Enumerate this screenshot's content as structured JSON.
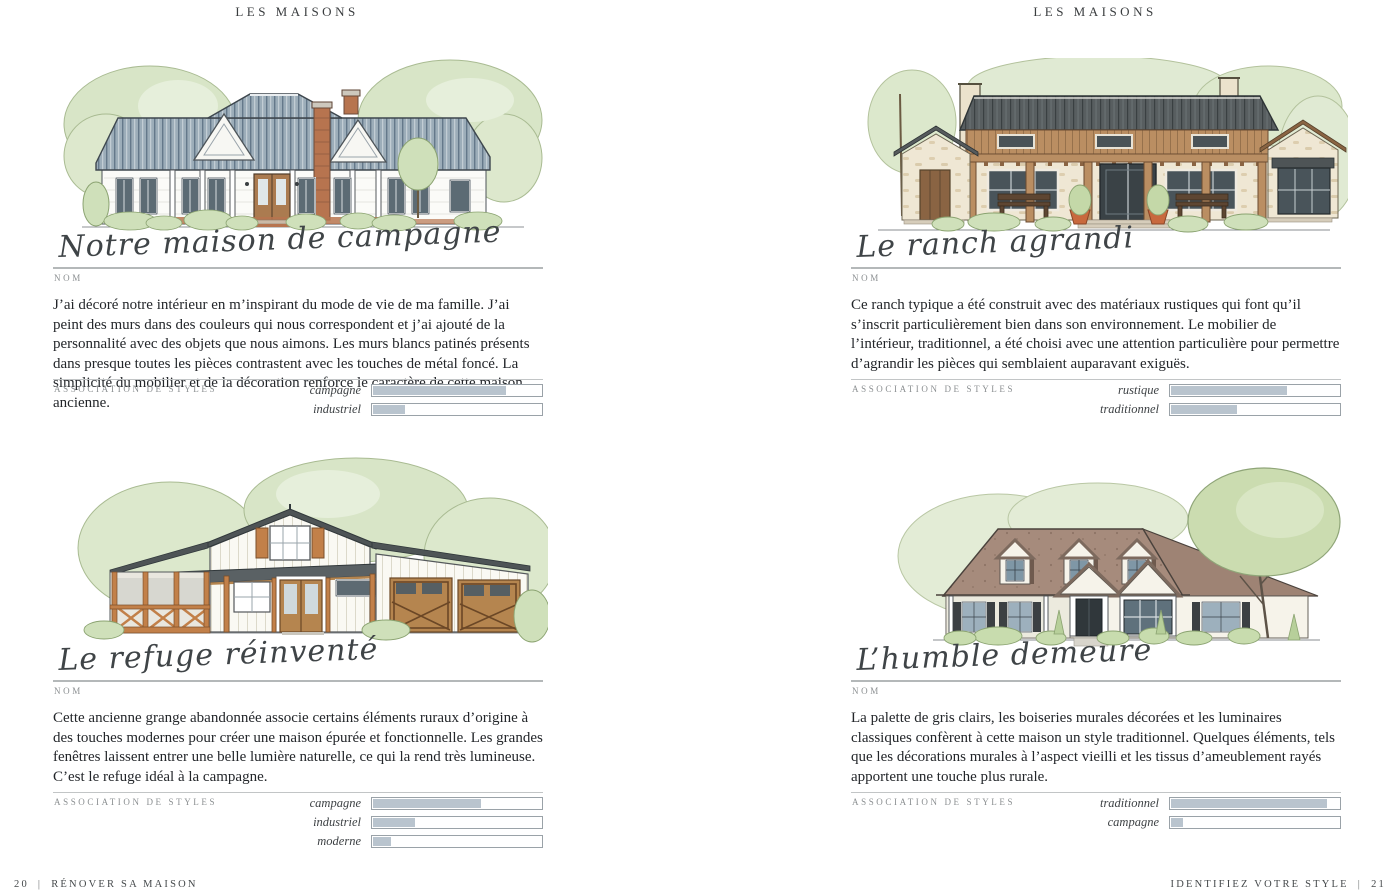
{
  "labels": {
    "name_label": "NOM",
    "styles_title": "ASSOCIATION DE STYLES"
  },
  "colors": {
    "bar_fill": "#b9c4ce",
    "bar_border": "#9aa2a8",
    "rule_gray": "#b4b8b9"
  },
  "pages": {
    "left": {
      "header": "LES MAISONS",
      "footer": {
        "page_number": "20",
        "divider": "|",
        "title": "RÉNOVER SA MAISON"
      },
      "sections": [
        {
          "name": "Notre maison de campagne",
          "description": "J’ai décoré notre intérieur en m’inspirant du mode de vie de ma famille. J’ai peint des murs dans des couleurs qui nous correspondent et j’ai ajouté de la personnalité avec des objets que nous aimons. Les murs blancs patinés présents dans presque toutes les pièces contrastent avec les touches de métal foncé. La simplicité du mobilier et de la décoration renforce le caractère de cette maison ancienne.",
          "styles": [
            {
              "label": "campagne",
              "value": 79
            },
            {
              "label": "industriel",
              "value": 19
            }
          ]
        },
        {
          "name": "Le refuge réinventé",
          "description": "Cette ancienne grange abandonnée associe certains éléments ruraux d’origine à des touches modernes pour créer une maison épurée et fonctionnelle. Les grandes fenêtres laissent entrer une belle lumière naturelle, ce qui la rend très lumineuse. C’est le refuge idéal à la campagne.",
          "styles": [
            {
              "label": "campagne",
              "value": 64
            },
            {
              "label": "industriel",
              "value": 25
            },
            {
              "label": "moderne",
              "value": 11
            }
          ]
        }
      ]
    },
    "right": {
      "header": "LES MAISONS",
      "footer": {
        "title": "IDENTIFIEZ VOTRE STYLE",
        "divider": "|",
        "page_number": "21"
      },
      "sections": [
        {
          "name": "Le ranch agrandi",
          "description": "Ce ranch typique a été construit avec des matériaux rustiques qui font qu’il s’inscrit particulièrement bien dans son environnement. Le mobilier de l’intérieur, traditionnel, a été choisi avec une attention particulière pour permettre d’agrandir les pièces qui semblaient auparavant exiguës.",
          "styles": [
            {
              "label": "rustique",
              "value": 69
            },
            {
              "label": "traditionnel",
              "value": 39
            }
          ]
        },
        {
          "name": "L’humble demeure",
          "description": "La palette de gris clairs, les boiseries murales décorées et les luminaires classiques confèrent à cette maison un style traditionnel. Quelques éléments, tels que les décorations murales à l’aspect vieilli et les tissus d’ameublement rayés apportent une touche plus rurale.",
          "styles": [
            {
              "label": "traditionnel",
              "value": 93
            },
            {
              "label": "campagne",
              "value": 7
            }
          ]
        }
      ]
    }
  }
}
